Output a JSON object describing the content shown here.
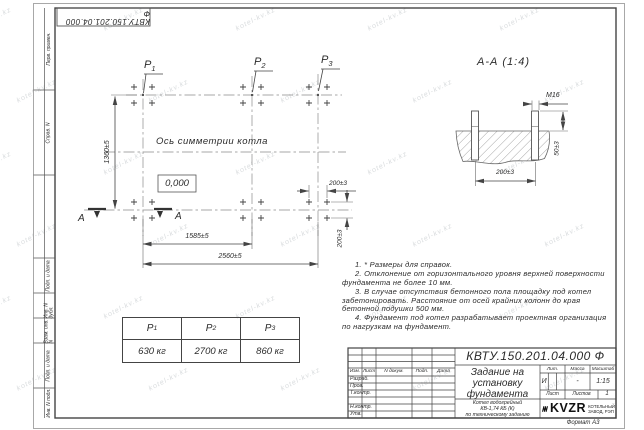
{
  "stamp_top": "КВТУ.150.201.04.000 Ф",
  "watermark": {
    "text": "kotel-kv.kz"
  },
  "frame_labels": {
    "perv_primen": "Перв. примен.",
    "sprav_n": "Справ. N",
    "podp_data_1": "Подп. и дата",
    "inv_dubl": "Инв. N дубл.",
    "vzam_inv": "Взам. инв. N",
    "podp_data_2": "Подп. и дата",
    "inv_podl": "Инв. N подл."
  },
  "plan": {
    "points": [
      {
        "base": "P",
        "sub": "1"
      },
      {
        "base": "P",
        "sub": "2"
      },
      {
        "base": "P",
        "sub": "3"
      }
    ],
    "axis_label": "Ось симметрии котла",
    "elevation": "0,000",
    "section_letter": "А",
    "dims": {
      "height": "1360±5",
      "span_p1_p2": "1585±5",
      "span_total": "2560±5",
      "bolt_x": "200±3",
      "bolt_y": "200±3"
    }
  },
  "section": {
    "title": "А-А (1:4)",
    "thread": "М16",
    "protrusion": "50±3",
    "spacing": "200±3"
  },
  "notes": [
    "1. * Размеры для справок.",
    "2. Отклонение от горизонтального уровня верхней поверхности фундамента не более 10 мм.",
    "3. В случае отсутствия бетонного пола площадку под котел забетонировать. Расстояние от осей крайних колонн до края бетонной подушки 500 мм.",
    "4. Фундамент под котел разрабатывает проектная организация по нагрузкам на фундамент."
  ],
  "load_table": {
    "headers": [
      {
        "base": "P",
        "sub": "1"
      },
      {
        "base": "P",
        "sub": "2"
      },
      {
        "base": "P",
        "sub": "3"
      }
    ],
    "values": [
      "630 кг",
      "2700 кг",
      "860 кг"
    ]
  },
  "title_block": {
    "doc_number": "КВТУ.150.201.04.000 Ф",
    "title_lines": [
      "Задание на",
      "установку",
      "фундамента"
    ],
    "product_lines": [
      "Котел водогрейный",
      "КВ-1,74 КБ (К)",
      "по техническому заданию"
    ],
    "rev_headers": [
      "Изм.",
      "Лист",
      "N докум.",
      "Подп.",
      "Дата"
    ],
    "row_labels": [
      "Разраб.",
      "Пров.",
      "Т.контр.",
      "Н.контр.",
      "Утв."
    ],
    "lit_header": "Лит.",
    "mass_header": "Масса",
    "scale_header": "Масштаб",
    "lit_value": "И",
    "mass_value": "-",
    "scale_value": "1:15",
    "sheet_label": "Лист",
    "sheets_label": "Листов",
    "sheets_value": "1",
    "logo_text": "KVZR",
    "company_lines": [
      "КОТЕЛЬНЫЙ",
      "ЗАВОД, РЭП"
    ],
    "format_label": "Формат А3"
  }
}
